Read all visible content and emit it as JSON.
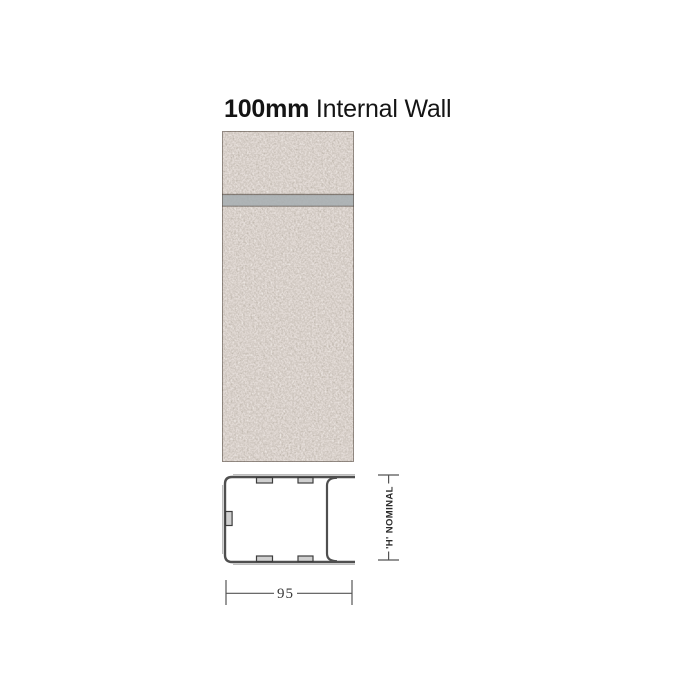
{
  "title": {
    "size": "100mm",
    "label": "Internal Wall"
  },
  "wall_figure": {
    "description": "speckled concrete blockwork with one horizontal mortar joint",
    "colors": {
      "block_base": "#b0a49b",
      "speckle_dark": "#6e6057",
      "speckle_light": "#e6dfd7",
      "mortar_joint": "#a7adb1",
      "edge_line": "#5d564e"
    }
  },
  "cross_section": {
    "description": "steel box lintel profile, open side right with top and bottom bearing tails",
    "outline_color": "#4f4f4f",
    "dimension_line_color": "#555555",
    "width_dimension": {
      "label": "95"
    },
    "height_dimension": {
      "label": "'H' NOMINAL"
    }
  }
}
